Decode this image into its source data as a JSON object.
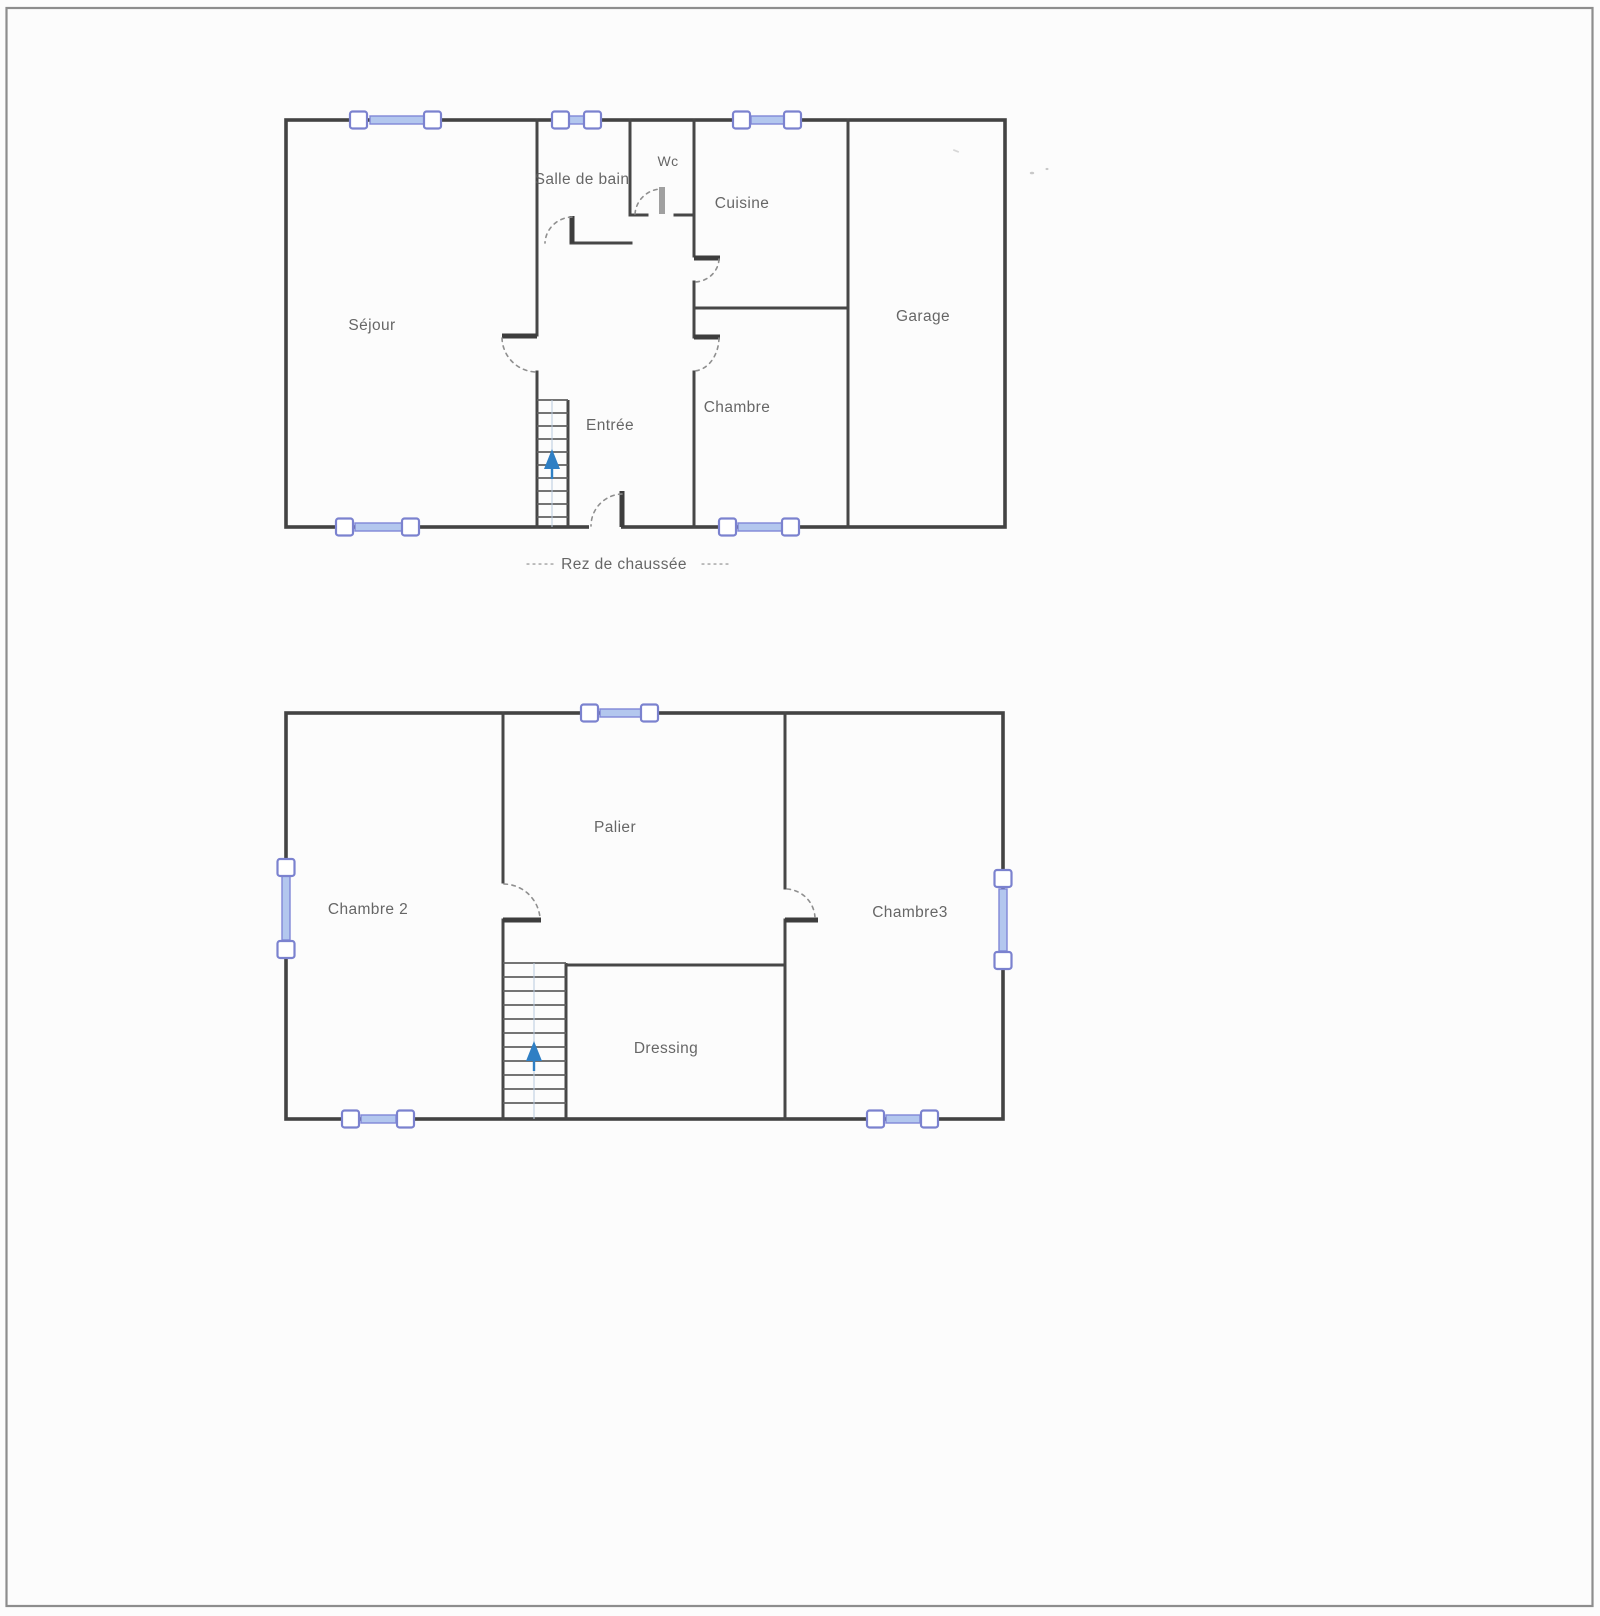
{
  "document": {
    "kind": "scanned floor plan, two levels"
  },
  "colors": {
    "paper": "#fcfcfc",
    "frame": "#8d8d8d",
    "wall": "#474747",
    "window_glass": "#b3c7ee",
    "window_frame": "#7b82cf",
    "door_arc": "#8f8f8f",
    "stair_arrow": "#2f7fc4",
    "label_text": "#5a5a5a"
  },
  "ground_floor": {
    "rooms": {
      "sejour": "Séjour",
      "salle_de_bain": "Salle de bain",
      "wc": "Wc",
      "cuisine": "Cuisine",
      "garage": "Garage",
      "entree": "Entrée",
      "chambre": "Chambre"
    },
    "caption": {
      "dashes_left": "-----",
      "label": "Rez de chaussée",
      "dashes_right": "-----"
    }
  },
  "first_floor": {
    "rooms": {
      "chambre2": "Chambre 2",
      "palier": "Palier",
      "chambre3": "Chambre3",
      "dressing": "Dressing"
    }
  }
}
